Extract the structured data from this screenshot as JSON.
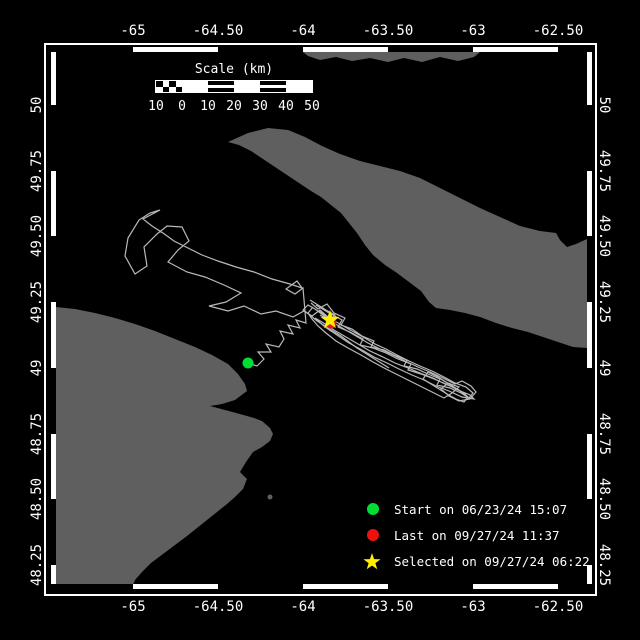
{
  "colors": {
    "background": "#000000",
    "land": "#5f5f5f",
    "track": "#b9b9b9",
    "frame": "#ffffff",
    "text": "#ffffff",
    "start_marker": "#00dd33",
    "last_marker": "#ee1111",
    "selected_marker": "#ffee00"
  },
  "axes": {
    "x_ticks": [
      {
        "label": "-65",
        "px": 133
      },
      {
        "label": "-64.50",
        "px": 218
      },
      {
        "label": "-64",
        "px": 303
      },
      {
        "label": "-63.50",
        "px": 388
      },
      {
        "label": "-63",
        "px": 473
      },
      {
        "label": "-62.50",
        "px": 558
      }
    ],
    "y_ticks": [
      {
        "label": "50",
        "px": 105
      },
      {
        "label": "49.75",
        "px": 171
      },
      {
        "label": "49.50",
        "px": 236
      },
      {
        "label": "49.25",
        "px": 302
      },
      {
        "label": "49",
        "px": 368
      },
      {
        "label": "48.75",
        "px": 434
      },
      {
        "label": "48.50",
        "px": 499
      },
      {
        "label": "48.25",
        "px": 565
      }
    ],
    "lon_range": [
      -65.48,
      -62.32
    ],
    "lat_range": [
      48.16,
      50.2
    ]
  },
  "scale_bar": {
    "title": "Scale (km)",
    "labels": [
      "10",
      "0",
      "10",
      "20",
      "30",
      "40",
      "50"
    ],
    "section_styles": [
      "checker",
      "solid",
      "striped",
      "solid",
      "striped",
      "solid"
    ]
  },
  "legend": {
    "items": [
      {
        "marker": "circle",
        "color": "#00dd33",
        "label": "Start on 06/23/24 15:07"
      },
      {
        "marker": "circle",
        "color": "#ee1111",
        "label": "Last on 09/27/24 11:37"
      },
      {
        "marker": "star",
        "color": "#ffee00",
        "label": "Selected on 09/27/24 06:22"
      }
    ]
  },
  "map": {
    "land_polygons": [
      {
        "name": "anticosti-island",
        "points": [
          [
            228,
            142
          ],
          [
            248,
            133
          ],
          [
            268,
            128
          ],
          [
            288,
            130
          ],
          [
            305,
            137
          ],
          [
            322,
            146
          ],
          [
            340,
            154
          ],
          [
            360,
            161
          ],
          [
            380,
            166
          ],
          [
            400,
            171
          ],
          [
            420,
            178
          ],
          [
            440,
            188
          ],
          [
            460,
            198
          ],
          [
            480,
            208
          ],
          [
            500,
            217
          ],
          [
            520,
            226
          ],
          [
            540,
            231
          ],
          [
            556,
            233
          ],
          [
            560,
            240
          ],
          [
            567,
            247
          ],
          [
            576,
            244
          ],
          [
            587,
            239
          ],
          [
            587,
            348
          ],
          [
            573,
            347
          ],
          [
            558,
            342
          ],
          [
            543,
            337
          ],
          [
            528,
            332
          ],
          [
            512,
            328
          ],
          [
            496,
            323
          ],
          [
            480,
            317
          ],
          [
            465,
            313
          ],
          [
            450,
            310
          ],
          [
            436,
            308
          ],
          [
            429,
            302
          ],
          [
            421,
            291
          ],
          [
            409,
            282
          ],
          [
            397,
            273
          ],
          [
            385,
            265
          ],
          [
            373,
            255
          ],
          [
            365,
            245
          ],
          [
            357,
            233
          ],
          [
            349,
            223
          ],
          [
            341,
            213
          ],
          [
            331,
            205
          ],
          [
            321,
            197
          ],
          [
            311,
            191
          ],
          [
            299,
            183
          ],
          [
            287,
            175
          ],
          [
            275,
            167
          ],
          [
            263,
            159
          ],
          [
            251,
            151
          ],
          [
            239,
            145
          ]
        ]
      },
      {
        "name": "north-shore",
        "points": [
          [
            303,
            52
          ],
          [
            480,
            52
          ],
          [
            474,
            57
          ],
          [
            458,
            61
          ],
          [
            440,
            57
          ],
          [
            422,
            62
          ],
          [
            404,
            58
          ],
          [
            388,
            62
          ],
          [
            370,
            58
          ],
          [
            352,
            61
          ],
          [
            336,
            57
          ],
          [
            320,
            60
          ],
          [
            308,
            56
          ]
        ]
      },
      {
        "name": "gaspe-peninsula",
        "points": [
          [
            56,
            307
          ],
          [
            75,
            309
          ],
          [
            95,
            313
          ],
          [
            115,
            318
          ],
          [
            135,
            324
          ],
          [
            155,
            331
          ],
          [
            175,
            339
          ],
          [
            195,
            347
          ],
          [
            212,
            355
          ],
          [
            228,
            364
          ],
          [
            238,
            374
          ],
          [
            245,
            384
          ],
          [
            247,
            391
          ],
          [
            235,
            400
          ],
          [
            222,
            404
          ],
          [
            210,
            406
          ],
          [
            225,
            410
          ],
          [
            240,
            414
          ],
          [
            254,
            418
          ],
          [
            262,
            421
          ],
          [
            270,
            428
          ],
          [
            273,
            434
          ],
          [
            270,
            441
          ],
          [
            262,
            447
          ],
          [
            253,
            452
          ],
          [
            246,
            462
          ],
          [
            240,
            472
          ],
          [
            247,
            479
          ],
          [
            243,
            489
          ],
          [
            235,
            497
          ],
          [
            227,
            504
          ],
          [
            217,
            512
          ],
          [
            207,
            520
          ],
          [
            197,
            528
          ],
          [
            187,
            536
          ],
          [
            175,
            545
          ],
          [
            163,
            554
          ],
          [
            151,
            563
          ],
          [
            142,
            572
          ],
          [
            135,
            580
          ],
          [
            132,
            587
          ],
          [
            56,
            587
          ]
        ]
      }
    ],
    "islets": [
      {
        "name": "bonaventure-island",
        "cx": 270,
        "cy": 497,
        "r": 2.5
      }
    ],
    "track_polylines": [
      [
        [
          248,
          363
        ],
        [
          257,
          366
        ],
        [
          264,
          359
        ],
        [
          258,
          352
        ],
        [
          271,
          352
        ],
        [
          266,
          344
        ],
        [
          279,
          347
        ],
        [
          284,
          339
        ],
        [
          280,
          331
        ],
        [
          293,
          334
        ],
        [
          288,
          325
        ],
        [
          300,
          328
        ],
        [
          296,
          320
        ],
        [
          306,
          323
        ],
        [
          303,
          288
        ],
        [
          295,
          294
        ],
        [
          286,
          289
        ],
        [
          297,
          281
        ],
        [
          302,
          288
        ],
        [
          290,
          284
        ],
        [
          272,
          279
        ],
        [
          254,
          272
        ],
        [
          236,
          267
        ],
        [
          218,
          261
        ],
        [
          202,
          255
        ],
        [
          188,
          248
        ],
        [
          174,
          241
        ],
        [
          163,
          233
        ],
        [
          152,
          226
        ],
        [
          143,
          219
        ],
        [
          160,
          210
        ],
        [
          150,
          213
        ],
        [
          139,
          220
        ],
        [
          128,
          238
        ],
        [
          125,
          256
        ],
        [
          135,
          274
        ],
        [
          147,
          266
        ],
        [
          144,
          247
        ],
        [
          157,
          234
        ],
        [
          167,
          226
        ],
        [
          182,
          227
        ],
        [
          189,
          241
        ],
        [
          178,
          250
        ],
        [
          168,
          262
        ],
        [
          187,
          272
        ],
        [
          205,
          277
        ],
        [
          224,
          285
        ],
        [
          241,
          293
        ],
        [
          226,
          302
        ],
        [
          209,
          306
        ],
        [
          228,
          311
        ],
        [
          244,
          306
        ],
        [
          261,
          314
        ],
        [
          276,
          311
        ],
        [
          293,
          317
        ],
        [
          304,
          311
        ],
        [
          312,
          316
        ],
        [
          320,
          310
        ],
        [
          328,
          317
        ],
        [
          330,
          320
        ]
      ],
      [
        [
          311,
          303
        ],
        [
          318,
          309
        ],
        [
          327,
          304
        ],
        [
          334,
          313
        ],
        [
          345,
          318
        ],
        [
          341,
          325
        ],
        [
          352,
          329
        ],
        [
          362,
          336
        ],
        [
          374,
          341
        ],
        [
          371,
          347
        ],
        [
          384,
          350
        ],
        [
          396,
          356
        ],
        [
          407,
          360
        ],
        [
          404,
          366
        ],
        [
          417,
          369
        ],
        [
          428,
          374
        ],
        [
          440,
          379
        ],
        [
          437,
          385
        ],
        [
          450,
          388
        ],
        [
          461,
          393
        ],
        [
          469,
          398
        ],
        [
          473,
          393
        ],
        [
          466,
          387
        ],
        [
          455,
          383
        ],
        [
          444,
          377
        ],
        [
          432,
          371
        ],
        [
          420,
          366
        ],
        [
          409,
          361
        ],
        [
          397,
          355
        ],
        [
          386,
          349
        ],
        [
          375,
          344
        ],
        [
          363,
          337
        ],
        [
          352,
          331
        ],
        [
          340,
          324
        ],
        [
          329,
          318
        ],
        [
          319,
          311
        ]
      ],
      [
        [
          316,
          305
        ],
        [
          329,
          313
        ],
        [
          342,
          320
        ],
        [
          338,
          327
        ],
        [
          350,
          332
        ],
        [
          363,
          339
        ],
        [
          360,
          345
        ],
        [
          373,
          348
        ],
        [
          386,
          353
        ],
        [
          398,
          359
        ],
        [
          411,
          364
        ],
        [
          408,
          370
        ],
        [
          421,
          374
        ],
        [
          434,
          379
        ],
        [
          446,
          384
        ],
        [
          458,
          390
        ],
        [
          470,
          395
        ],
        [
          474,
          399
        ],
        [
          462,
          397
        ],
        [
          449,
          391
        ],
        [
          436,
          386
        ],
        [
          424,
          380
        ],
        [
          412,
          375
        ],
        [
          399,
          369
        ],
        [
          387,
          363
        ],
        [
          374,
          357
        ],
        [
          362,
          350
        ],
        [
          349,
          343
        ],
        [
          337,
          335
        ],
        [
          325,
          327
        ],
        [
          315,
          318
        ],
        [
          322,
          322
        ],
        [
          334,
          330
        ],
        [
          346,
          337
        ],
        [
          358,
          344
        ],
        [
          370,
          351
        ],
        [
          383,
          357
        ],
        [
          395,
          363
        ],
        [
          408,
          368
        ],
        [
          420,
          373
        ],
        [
          433,
          378
        ],
        [
          445,
          384
        ],
        [
          457,
          389
        ],
        [
          466,
          394
        ]
      ],
      [
        [
          320,
          315
        ],
        [
          332,
          322
        ],
        [
          344,
          329
        ],
        [
          356,
          336
        ],
        [
          368,
          343
        ],
        [
          380,
          349
        ],
        [
          393,
          355
        ],
        [
          405,
          361
        ],
        [
          418,
          367
        ],
        [
          430,
          372
        ],
        [
          443,
          378
        ],
        [
          455,
          384
        ],
        [
          462,
          381
        ],
        [
          471,
          386
        ],
        [
          476,
          392
        ],
        [
          470,
          399
        ],
        [
          459,
          401
        ],
        [
          449,
          396
        ],
        [
          441,
          389
        ],
        [
          448,
          383
        ],
        [
          459,
          387
        ],
        [
          452,
          393
        ],
        [
          444,
          398
        ],
        [
          434,
          393
        ],
        [
          422,
          387
        ],
        [
          410,
          381
        ],
        [
          398,
          375
        ],
        [
          386,
          369
        ],
        [
          373,
          362
        ],
        [
          361,
          355
        ],
        [
          348,
          348
        ],
        [
          336,
          341
        ],
        [
          326,
          333
        ],
        [
          318,
          326
        ],
        [
          312,
          319
        ],
        [
          308,
          313
        ],
        [
          313,
          307
        ]
      ],
      [
        [
          310,
          300
        ],
        [
          318,
          305
        ],
        [
          326,
          310
        ],
        [
          335,
          315
        ],
        [
          330,
          321
        ],
        [
          323,
          315
        ],
        [
          315,
          309
        ],
        [
          308,
          305
        ],
        [
          303,
          310
        ],
        [
          310,
          315
        ],
        [
          317,
          321
        ],
        [
          325,
          326
        ],
        [
          333,
          331
        ],
        [
          341,
          336
        ],
        [
          349,
          342
        ],
        [
          357,
          348
        ],
        [
          365,
          353
        ],
        [
          373,
          358
        ],
        [
          381,
          363
        ],
        [
          389,
          368
        ]
      ],
      [
        [
          430,
          372
        ],
        [
          438,
          377
        ],
        [
          446,
          382
        ],
        [
          454,
          387
        ],
        [
          462,
          392
        ],
        [
          468,
          397
        ],
        [
          464,
          402
        ],
        [
          456,
          399
        ],
        [
          447,
          394
        ],
        [
          439,
          389
        ],
        [
          431,
          384
        ],
        [
          423,
          379
        ],
        [
          428,
          372
        ],
        [
          436,
          376
        ],
        [
          444,
          381
        ],
        [
          452,
          386
        ],
        [
          460,
          391
        ],
        [
          466,
          396
        ]
      ]
    ],
    "markers": {
      "start": {
        "x": 248,
        "y": 363,
        "r": 5.5
      },
      "last": {
        "x": 331,
        "y": 323,
        "r": 5.5
      },
      "selected": {
        "x": 330,
        "y": 320,
        "R": 10,
        "r": 4
      }
    }
  }
}
